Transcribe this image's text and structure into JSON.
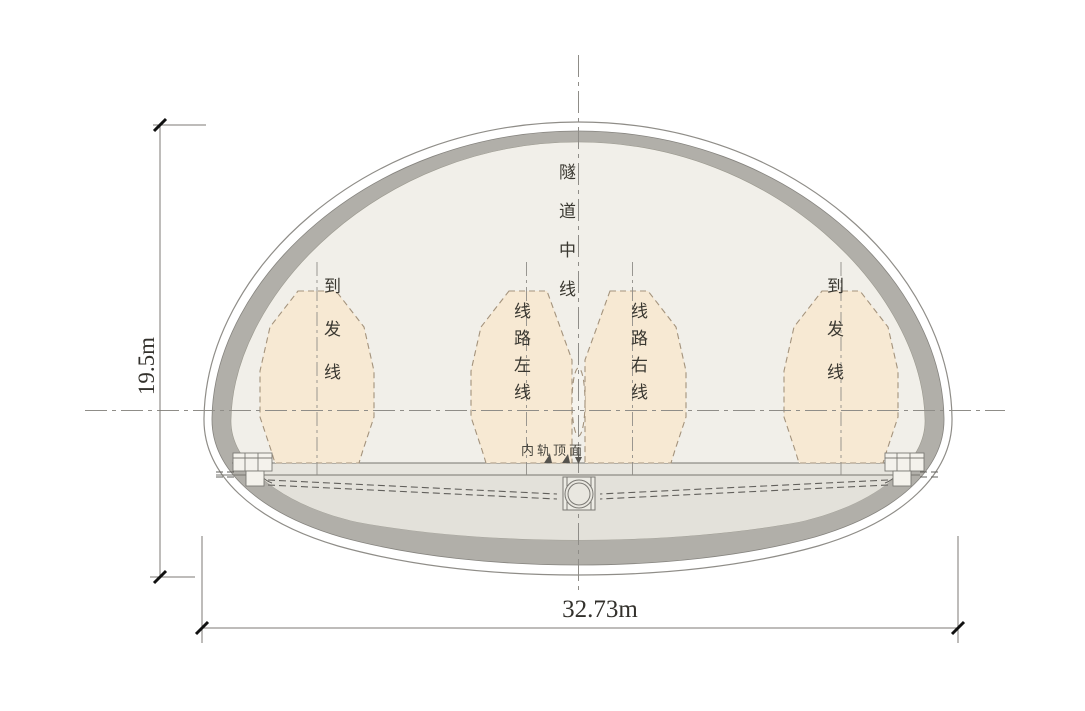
{
  "diagram": {
    "type": "railway-tunnel-cross-section",
    "labels": {
      "tunnel_centerline": "隧道中线",
      "siding_track_left": "到发线",
      "siding_track_right": "到发线",
      "main_line_left": "线路左线",
      "main_line_right": "线路右线",
      "rail_top_surface": "内轨顶面"
    },
    "dimensions": {
      "height": "19.5m",
      "width": "32.73m"
    },
    "colors": {
      "lining_gray": "#b1afa9",
      "interior_fill": "#f1efe9",
      "clearance_envelope_fill": "#f7e9d3",
      "envelope_dash_stroke": "#a4937c",
      "invert_fill": "#e3e1da",
      "centerline_stroke": "#8f8d88",
      "dimension_stroke": "#7c7a76"
    }
  }
}
